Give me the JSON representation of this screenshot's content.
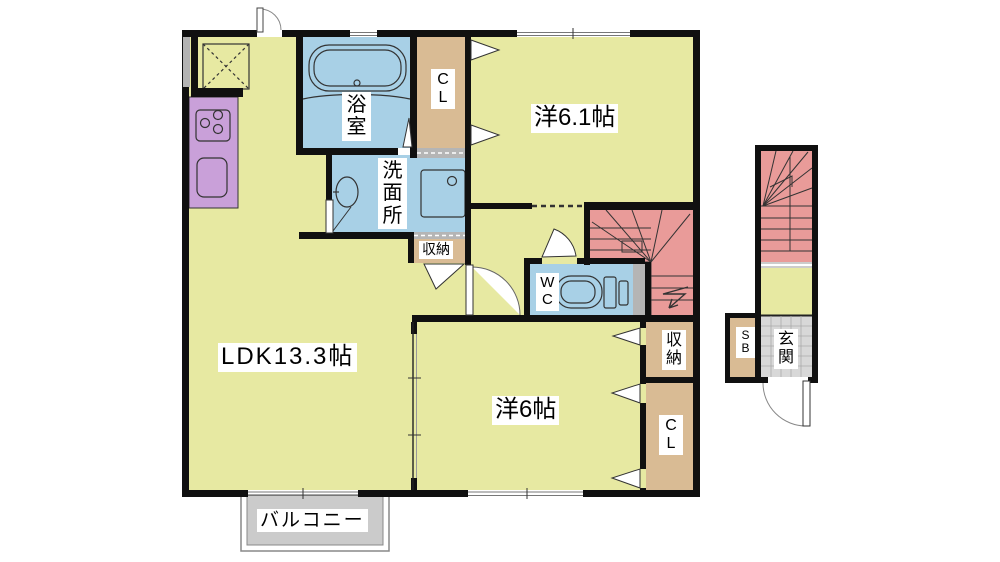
{
  "plan_title": "apartment-floor-plan",
  "colors": {
    "floor": "#e7e9a2",
    "wet": "#a8d0e6",
    "closet": "#d9bb94",
    "kitchen": "#c9a0d9",
    "stairs": "#e99b99",
    "balcony": "#cbcbcb",
    "tile": "#d8d8d8",
    "hatch": "#b5b5b5",
    "wall": "#101010"
  },
  "labels": {
    "bath": "浴室",
    "washroom": "洗面所",
    "closet_top": "CL",
    "bedroom1": "洋6.1帖",
    "storage_hall": "収納",
    "wc": "WC",
    "storage_stairs": "収納",
    "ldk": "LDK13.3帖",
    "bedroom2": "洋6帖",
    "closet_bottom": "CL",
    "shoebox": "SB",
    "entrance": "玄関",
    "balcony": "バルコニー"
  }
}
